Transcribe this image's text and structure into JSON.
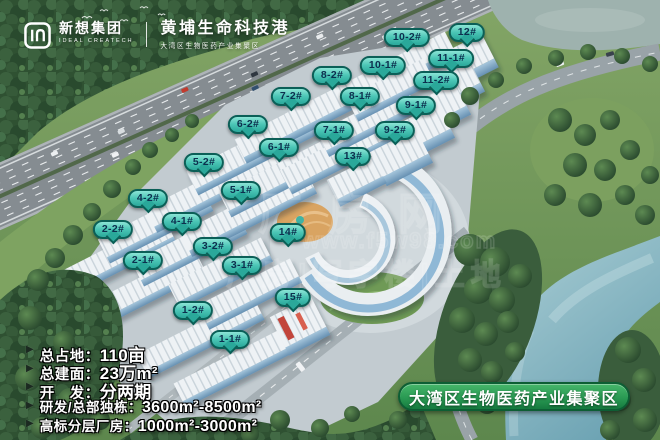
{
  "header": {
    "brand": {
      "name": "新想集团",
      "name_en": "IDEAL CREATECH"
    },
    "project": {
      "title": "黄埔生命科技港",
      "subtitle": "大湾区生物医药产业集聚区"
    }
  },
  "labels": [
    {
      "text": "10-2#",
      "x": 407,
      "y": 39
    },
    {
      "text": "12#",
      "x": 467,
      "y": 34
    },
    {
      "text": "11-1#",
      "x": 451,
      "y": 60
    },
    {
      "text": "10-1#",
      "x": 383,
      "y": 67
    },
    {
      "text": "8-2#",
      "x": 332,
      "y": 77
    },
    {
      "text": "11-2#",
      "x": 436,
      "y": 82
    },
    {
      "text": "7-2#",
      "x": 291,
      "y": 98
    },
    {
      "text": "8-1#",
      "x": 360,
      "y": 98
    },
    {
      "text": "9-1#",
      "x": 416,
      "y": 107
    },
    {
      "text": "6-2#",
      "x": 248,
      "y": 126
    },
    {
      "text": "7-1#",
      "x": 334,
      "y": 132
    },
    {
      "text": "9-2#",
      "x": 395,
      "y": 132
    },
    {
      "text": "6-1#",
      "x": 279,
      "y": 149
    },
    {
      "text": "13#",
      "x": 353,
      "y": 158
    },
    {
      "text": "5-2#",
      "x": 204,
      "y": 164
    },
    {
      "text": "5-1#",
      "x": 241,
      "y": 192
    },
    {
      "text": "4-2#",
      "x": 148,
      "y": 200
    },
    {
      "text": "4-1#",
      "x": 182,
      "y": 223
    },
    {
      "text": "2-2#",
      "x": 113,
      "y": 231
    },
    {
      "text": "14#",
      "x": 288,
      "y": 234
    },
    {
      "text": "3-2#",
      "x": 213,
      "y": 248
    },
    {
      "text": "2-1#",
      "x": 143,
      "y": 262
    },
    {
      "text": "3-1#",
      "x": 242,
      "y": 267
    },
    {
      "text": "15#",
      "x": 293,
      "y": 299
    },
    {
      "text": "1-2#",
      "x": 193,
      "y": 312
    },
    {
      "text": "1-1#",
      "x": 230,
      "y": 341
    }
  ],
  "stats": {
    "items": [
      {
        "label": "总占地：",
        "value": "110亩"
      },
      {
        "label": "总建面：",
        "value": "23万m²"
      },
      {
        "label": "开　发：",
        "value": "分两期"
      },
      {
        "label": "研发/总部独栋：",
        "value": "3600m²-8500m²"
      },
      {
        "label": "高标分层厂房：",
        "value": "1000m²-3000m²"
      }
    ]
  },
  "banner": {
    "text": "大湾区生物医药产业集聚区"
  },
  "watermark": {
    "line1": "厂房网",
    "url": "www.f5w98.com",
    "line2": "厂房|写字楼|土地"
  },
  "colors": {
    "label_fill": "#4cc6b6",
    "label_border": "#0b5f57",
    "label_text": "#0c2f4e",
    "banner_green": "#2a9a53",
    "banner_border": "#0d5e34"
  }
}
